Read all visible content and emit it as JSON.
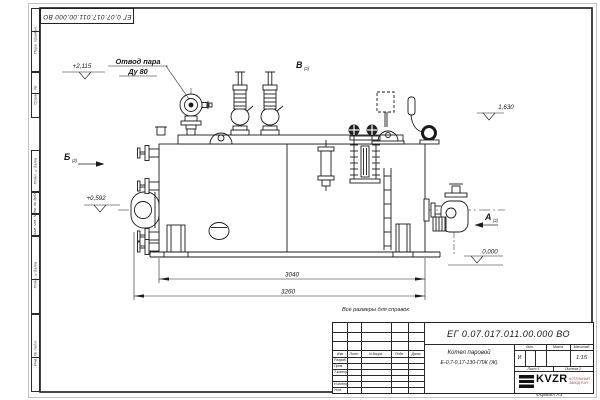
{
  "sheet": {
    "note": "Все размеры для справок",
    "format_label": "Формат А3"
  },
  "annotations": {
    "callout_line1": "Отвод пара",
    "callout_line2": "Ду 80",
    "dim_body_length": "3040",
    "dim_overall_length": "3260",
    "elev_valves": "+2,115",
    "elev_burner_axis": "+0,592",
    "elev_shell_top": "1,630",
    "elev_ground": "0,000",
    "view_b": "Б",
    "view_b_sub": "(2)",
    "view_v": "В",
    "view_v_sub": "(2)",
    "view_a": "А",
    "view_a_sub": "(2)"
  },
  "title_block": {
    "designation": "ЕГ 0.07.017.011.00.000  ВО",
    "product_name": "Котел паровой",
    "product_type": "Е-0,7-0,17-130-ГЛЖ (Ж)",
    "lit_header": "Лит.",
    "mass_header": "Масса",
    "scale_header": "Масштаб",
    "lit_value": "И",
    "scale_value": "1:15",
    "sheet_cell": "Лист 1",
    "sheets_cell": "Листов 2",
    "logo_text": "KVZR",
    "logo_sub1": "КОТЕЛЬНЫЙ",
    "logo_sub2": "ЗАВОД РЭП",
    "header_cols": [
      "Изм",
      "Лист",
      "N докум.",
      "Подп.",
      "Дата"
    ],
    "roles": [
      "Разраб.",
      "Пров.",
      "Т.контр.",
      "Н.контр.",
      "Утв."
    ]
  },
  "frame": {
    "side_labels": [
      "Перв. примен.",
      "Справ. №",
      "Подп. и дата",
      "Инв. № дубл.",
      "Взам. инв. №",
      "Подп. и дата",
      "Инв. № подл."
    ]
  }
}
